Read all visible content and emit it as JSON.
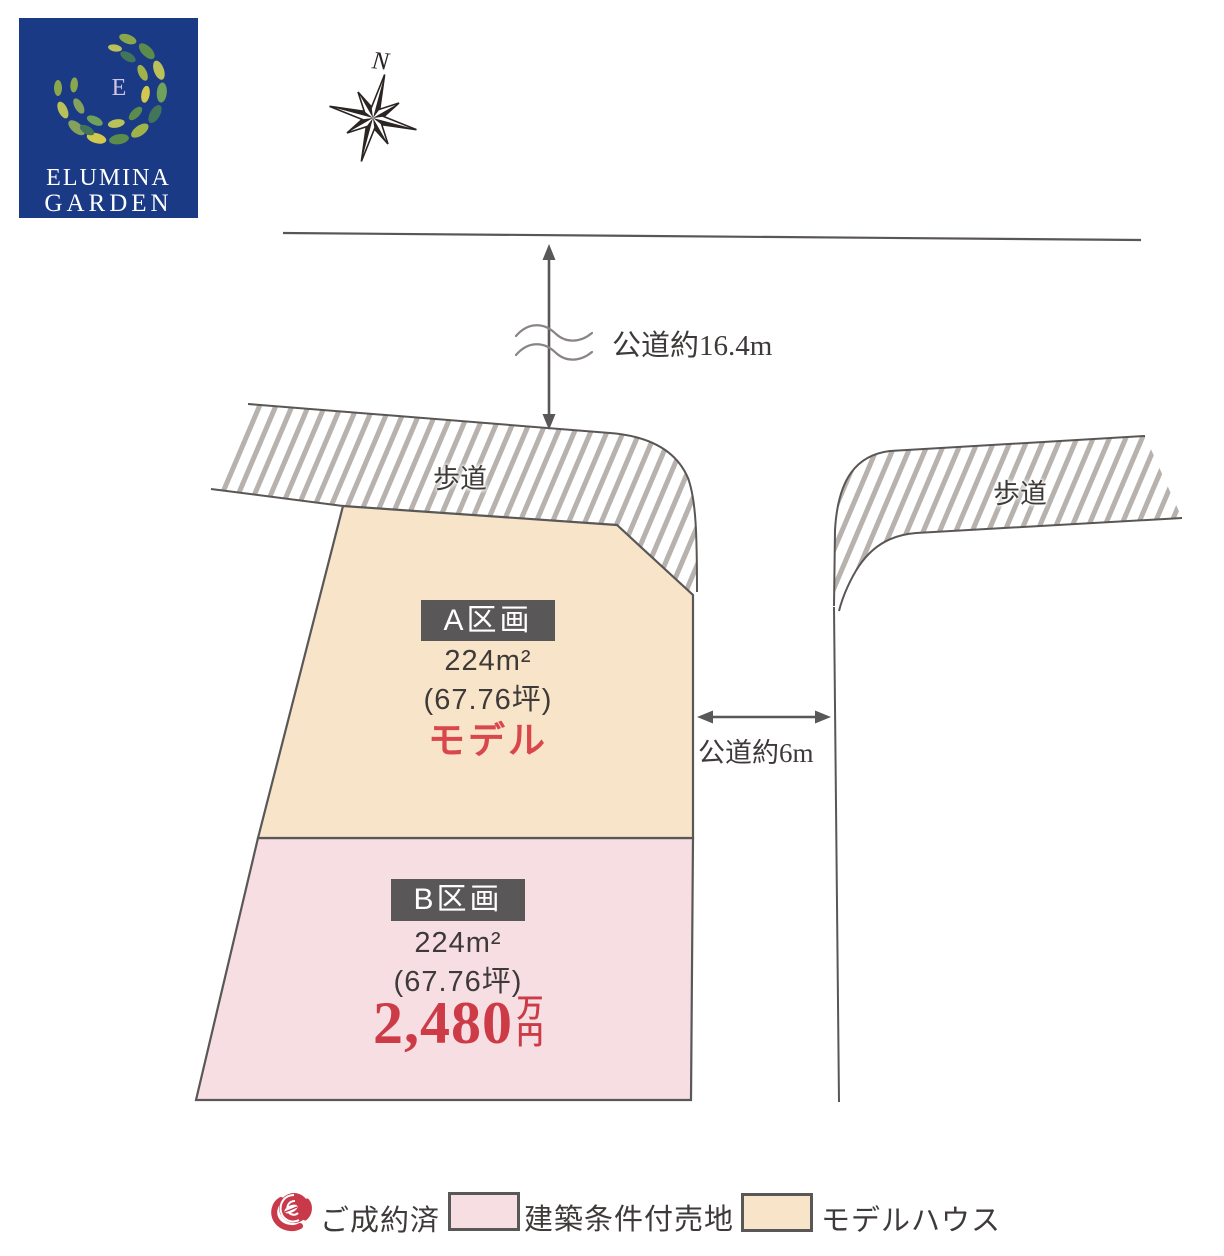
{
  "logo": {
    "monogram": "E",
    "brand_line1": "ELUMINA",
    "brand_line2": "GARDEN",
    "background_color": "#1a3a86"
  },
  "compass": {
    "north_label": "N"
  },
  "roads": {
    "front_road_label": "公道約16.4m",
    "side_road_label": "公道約6m"
  },
  "sidewalks": {
    "left_label": "歩道",
    "right_label": "歩道"
  },
  "lots": {
    "a": {
      "name": "A区画",
      "area_sqm": "224m²",
      "area_tsubo": "(67.76坪)",
      "status": "モデル",
      "fill_color": "#f8e4c8",
      "status_color": "#d9474d"
    },
    "b": {
      "name": "B区画",
      "area_sqm": "224m²",
      "area_tsubo": "(67.76坪)",
      "price_number": "2,480",
      "price_unit_top": "万",
      "price_unit_bottom": "円",
      "fill_color": "#f6dee3",
      "price_color": "#cc3b46"
    }
  },
  "legend": {
    "sold": {
      "label": "ご成約済",
      "icon": "rose-icon",
      "icon_color": "#c8394a"
    },
    "conditional_land": {
      "label": "建築条件付売地",
      "swatch_color": "#f6dee3"
    },
    "model_house": {
      "label": "モデルハウス",
      "swatch_color": "#f8e4c8"
    }
  }
}
